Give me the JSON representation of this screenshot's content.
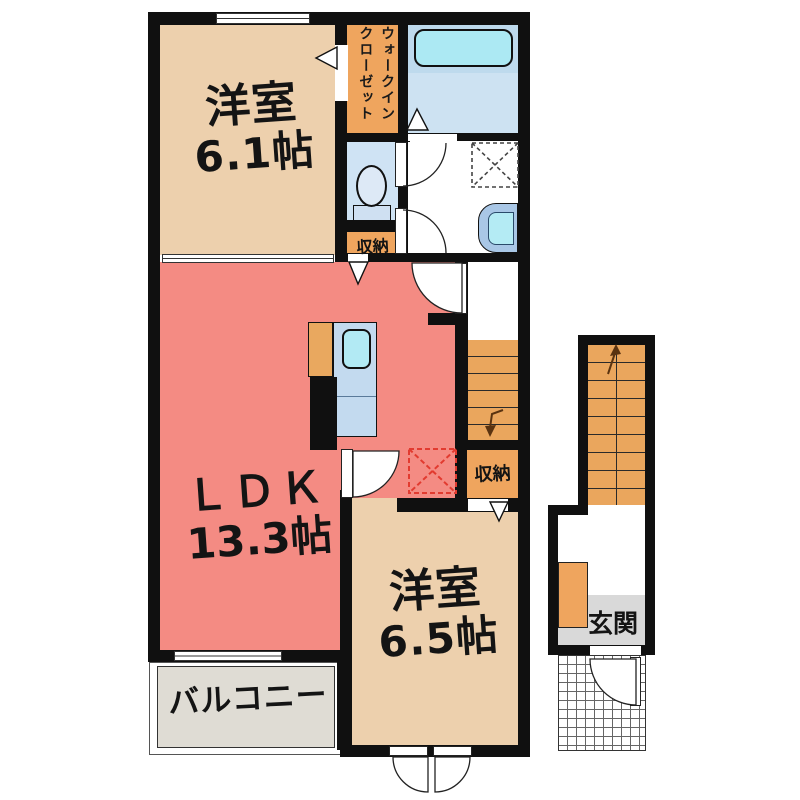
{
  "floorplan": {
    "unit_rooms": {
      "bedroom1": {
        "name": "洋室",
        "size": "6.1帖"
      },
      "ldk": {
        "name": "ＬＤＫ",
        "size": "13.3帖"
      },
      "bedroom2": {
        "name": "洋室",
        "size": "6.5帖"
      },
      "balcony": {
        "name": "バルコニー"
      },
      "entrance": {
        "name": "玄関"
      },
      "walk_in_closet": {
        "line1": "ウォークイン",
        "line2": "クローゼット"
      },
      "storage_upper": {
        "name": "収納"
      },
      "storage_lower": {
        "name": "収納"
      }
    },
    "fixtures": [
      "bathtub-icon",
      "toilet-icon",
      "kitchen-sink-icon",
      "washbasin-icon",
      "washing-machine-area",
      "refrigerator-area",
      "staircase-internal-down",
      "staircase-external-up",
      "entrance-porch-grid"
    ],
    "colors": {
      "wall": "#101010",
      "bedroom_beige": "#edd0ad",
      "ldk_salmon": "#f48b83",
      "accent_orange": "#efa55e",
      "water_room_blue": "#cfe3f4",
      "tub_cyan": "#ace9f3",
      "counter_blue": "#c3daef",
      "balcony_gray": "#dfdcd4",
      "entrance_gray": "#d9d9d9",
      "dashed_red": "#e23b30"
    }
  }
}
